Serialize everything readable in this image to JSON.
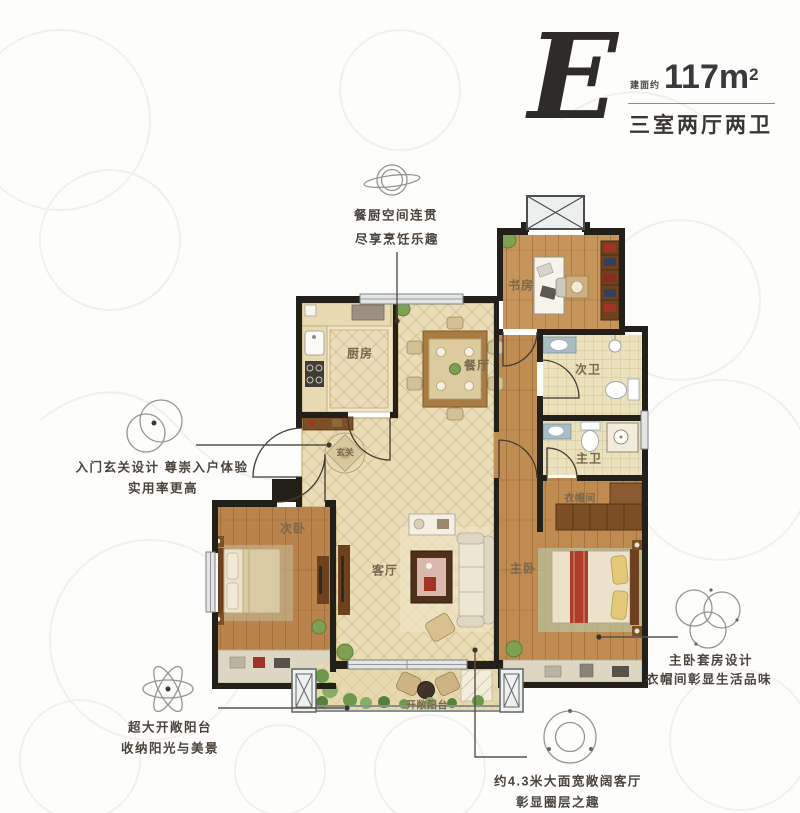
{
  "header": {
    "type_letter": "E",
    "area_prefix": "建面约",
    "area_value": "117m",
    "area_sup": "2",
    "layout_desc": "三室两厅两卫"
  },
  "rooms": {
    "kitchen": "厨房",
    "dining": "餐厅",
    "study": "书房",
    "second_bath": "次卫",
    "master_bath": "主卫",
    "cloakroom": "衣帽间",
    "foyer": "玄关",
    "second_bedroom": "次卧",
    "living_room": "客厅",
    "master_bedroom": "主卧",
    "balcony": "开敞阳台"
  },
  "annotations": {
    "kitchen_dining": {
      "line1": "餐厨空间连贯",
      "line2": "尽享烹饪乐趣"
    },
    "foyer": {
      "line1": "入门玄关设计 尊崇入户体验",
      "line2": "实用率更高"
    },
    "balcony": {
      "line1": "超大开敞阳台",
      "line2": "收纳阳光与美景"
    },
    "living": {
      "line1": "约4.3米大面宽敞阔客厅",
      "line2": "彰显圈层之趣"
    },
    "master_suite": {
      "line1": "主卧套房设计",
      "line2": "衣帽间彰显生活品味"
    }
  },
  "colors": {
    "wall": "#232019",
    "wood": "#c08b50",
    "tile": "#e9dcb6",
    "window": "#e3e6e5",
    "annotation_text": "#4b443b",
    "title_text": "#3a3632"
  }
}
